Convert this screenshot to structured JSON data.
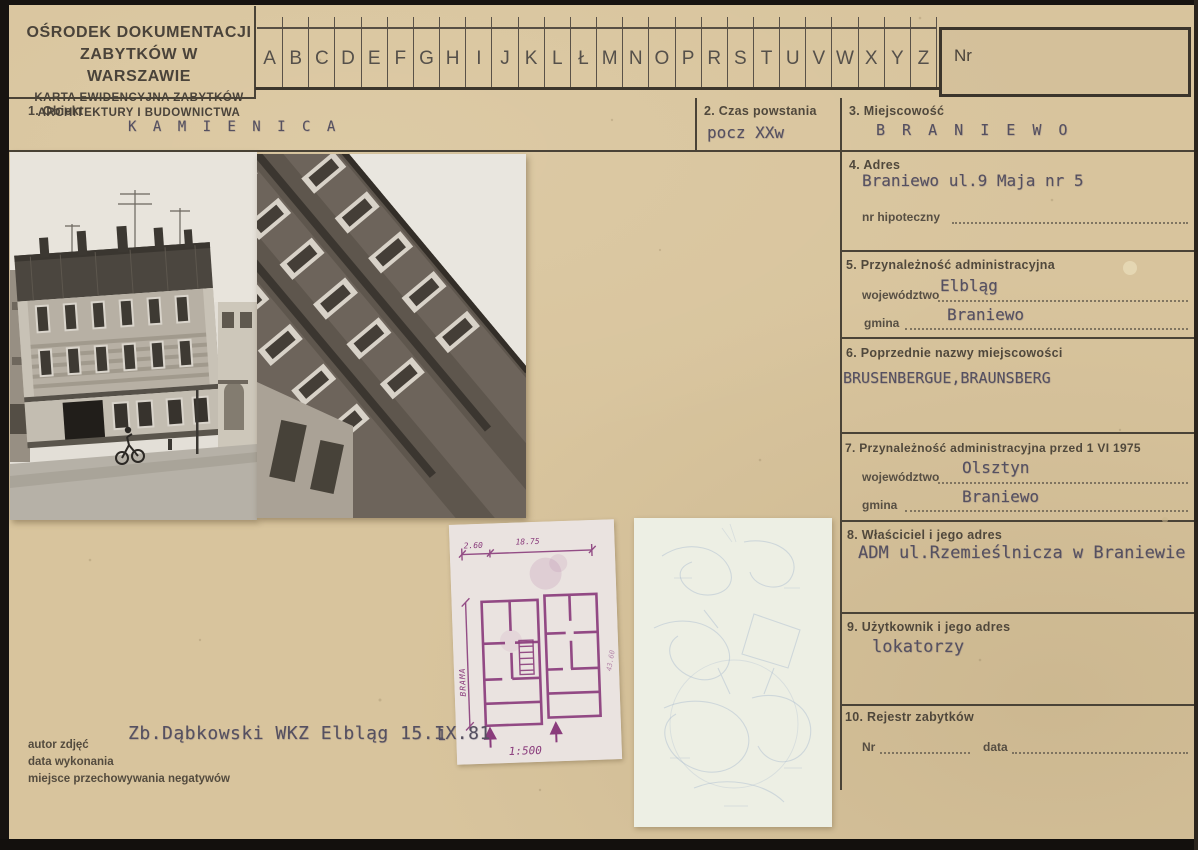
{
  "header": {
    "org_line1": "OŚRODEK DOKUMENTACJI",
    "org_line2": "ZABYTKÓW W WARSZAWIE",
    "card_line1": "KARTA EWIDENCYJNA ZABYTKÓW",
    "card_line2": "ARCHITEKTURY I BUDOWNICTWA",
    "alphabet": [
      "A",
      "B",
      "C",
      "D",
      "E",
      "F",
      "G",
      "H",
      "I",
      "J",
      "K",
      "L",
      "Ł",
      "M",
      "N",
      "O",
      "P",
      "R",
      "S",
      "T",
      "U",
      "V",
      "W",
      "X",
      "Y",
      "Z"
    ],
    "nr_label": "Nr",
    "nr_value": ""
  },
  "fields": {
    "obiekt": {
      "label": "1. Obiekt",
      "value": "K A M I E N I C A"
    },
    "czas": {
      "label": "2. Czas powstania",
      "value": "pocz XXw"
    },
    "miejscowosc": {
      "label": "3. Miejscowość",
      "value": "B R A N I E W O"
    },
    "adres": {
      "label": "4. Adres",
      "value": "Braniewo ul.9 Maja nr 5",
      "nr_hipoteczny_label": "nr hipoteczny",
      "nr_hipoteczny_value": ""
    },
    "przynaleznosc": {
      "label": "5. Przynależność administracyjna",
      "wojewodztwo_label": "województwo",
      "wojewodztwo_value": "Elbląg",
      "gmina_label": "gmina",
      "gmina_value": "Braniewo"
    },
    "poprzednie_nazwy": {
      "label": "6. Poprzednie nazwy miejscowości",
      "value": "BRUSENBERGUE,BRAUNSBERG"
    },
    "przynaleznosc_1975": {
      "label": "7. Przynależność administracyjna przed 1 VI 1975",
      "wojewodztwo_label": "województwo",
      "wojewodztwo_value": "Olsztyn",
      "gmina_label": "gmina",
      "gmina_value": "Braniewo"
    },
    "wlasciciel": {
      "label": "8. Właściciel i jego adres",
      "value": "ADM ul.Rzemieślnicza w Braniewie"
    },
    "uzytkownik": {
      "label": "9. Użytkownik i jego adres",
      "value": "lokatorzy"
    },
    "rejestr": {
      "label": "10. Rejestr zabytków",
      "nr_label": "Nr",
      "nr_value": "",
      "data_label": "data",
      "data_value": ""
    }
  },
  "photos": {
    "photo1": "street-facade-with-cyclist",
    "photo2": "diagonal-facade-closeup"
  },
  "plan": {
    "dim_top_left": "2.60",
    "dim_top": "18.75",
    "side_label": "BRAMA",
    "dim_right": "43.60",
    "scale": "1:500",
    "sheet_number": "1"
  },
  "footer": {
    "labels": [
      "autor zdjęć",
      "data wykonania",
      "miejsce przechowywania negatywów"
    ],
    "typed_note": "Zb.Dąbkowski WKZ Elbląg 15.IX.81"
  },
  "colors": {
    "card_bg": "#d8c49d",
    "print_ink": "#453e34",
    "typed_ink": "#555060",
    "plan_ink": "#8a3c7c",
    "tracing_ink": "#9db1cc"
  }
}
